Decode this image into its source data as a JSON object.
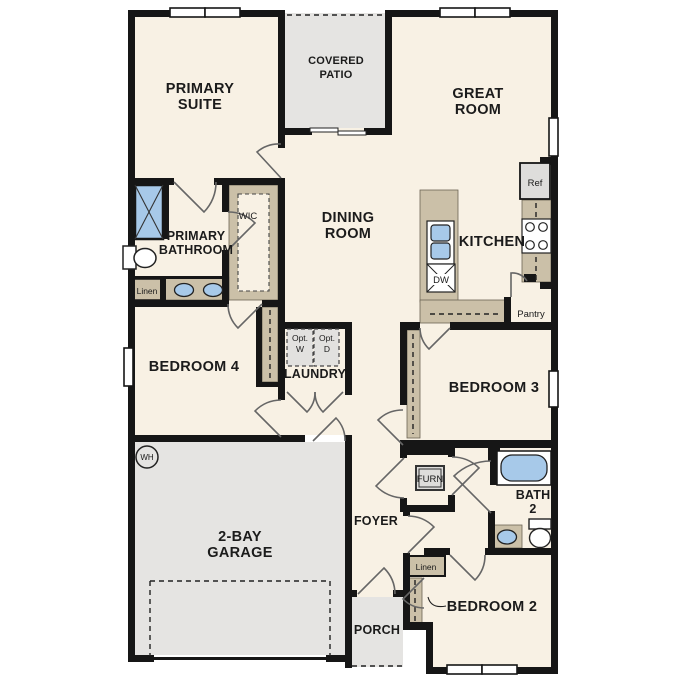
{
  "title": "Single-story floor plan",
  "colors": {
    "floor_cream": "#f8f1e4",
    "hard_surface_gray": "#e5e4e2",
    "counter_tan": "#cbc0a8",
    "fixture_blue": "#a7c9e9",
    "appliance_gray": "#dedddb",
    "wall_black": "#161616"
  },
  "labels": {
    "primary_suite_1": "PRIMARY",
    "primary_suite_2": "SUITE",
    "covered_patio_1": "COVERED",
    "covered_patio_2": "PATIO",
    "great_room_1": "GREAT",
    "great_room_2": "ROOM",
    "dining_room_1": "DINING",
    "dining_room_2": "ROOM",
    "kitchen": "KITCHEN",
    "ref": "Ref",
    "dw": "DW",
    "pantry": "Pantry",
    "wic": "WIC",
    "primary_bathroom_1": "PRIMARY",
    "primary_bathroom_2": "BATHROOM",
    "linen_primary": "Linen",
    "bedroom4": "BEDROOM 4",
    "opt_w_1": "Opt.",
    "opt_w_2": "W",
    "opt_d_1": "Opt.",
    "opt_d_2": "D",
    "laundry": "LAUNDRY",
    "garage_1": "2-BAY",
    "garage_2": "GARAGE",
    "wh": "WH",
    "foyer": "FOYER",
    "furn": "FURN",
    "bedroom3": "BEDROOM 3",
    "bath2_1": "BATH",
    "bath2_2": "2",
    "bedroom2": "BEDROOM 2",
    "linen_hall": "Linen",
    "porch": "PORCH"
  }
}
